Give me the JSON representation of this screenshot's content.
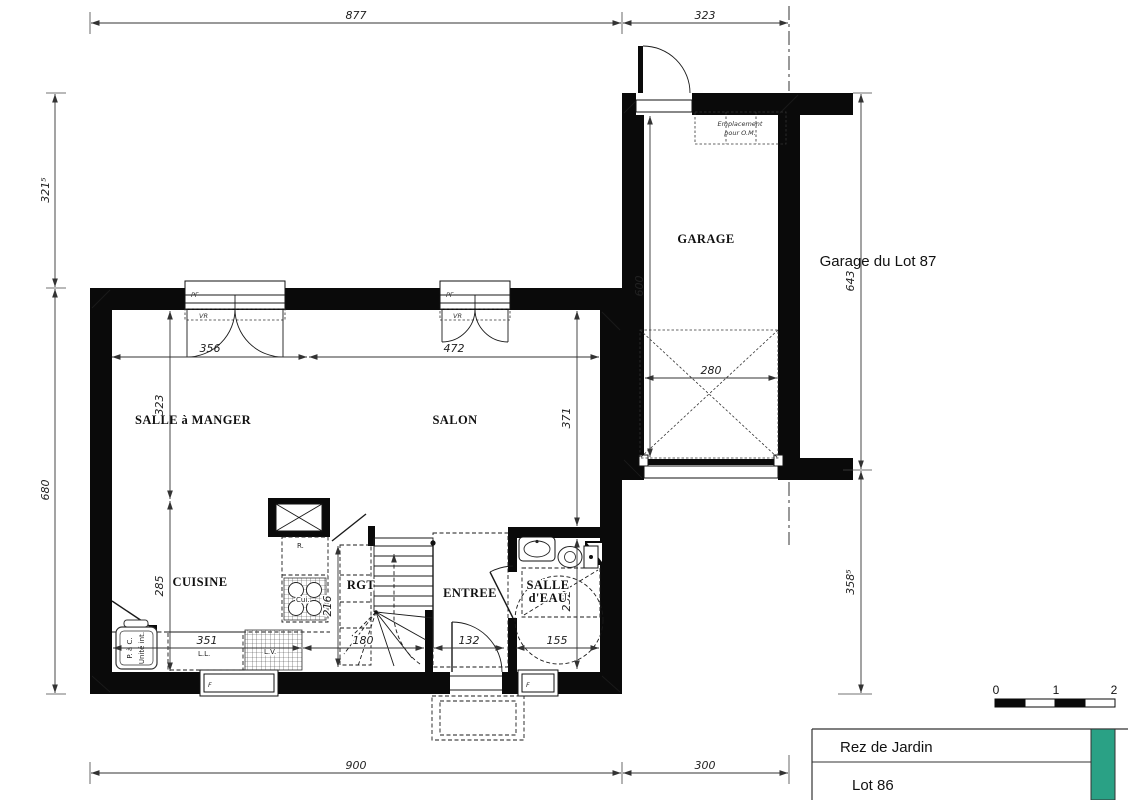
{
  "rooms": {
    "salle_a_manger": "SALLE à MANGER",
    "salon": "SALON",
    "cuisine": "CUISINE",
    "rgt": "RGT",
    "entree": "ENTREE",
    "salle_eau_1": "SALLE",
    "salle_eau_2": "d'EAU",
    "garage": "GARAGE"
  },
  "dims": {
    "d877": "877",
    "d323top": "323",
    "d3215": "321⁵",
    "d680": "680",
    "d643": "643",
    "d3585": "358⁵",
    "d900": "900",
    "d300": "300",
    "d356": "356",
    "d472": "472",
    "d323": "323",
    "d371": "371",
    "d285": "285",
    "d216": "216",
    "d232": "232",
    "d600": "600",
    "d280": "280",
    "d351": "351",
    "d180": "180",
    "d132": "132",
    "d155": "155"
  },
  "labels": {
    "garage_lot": "Garage du Lot 87",
    "om1": "Emplacement",
    "om2": "pour O.M.",
    "pac1": "P. à C.",
    "pac2": "Unité int.",
    "ll": "L.L.",
    "lv": "L.V.",
    "cui": "Cui.",
    "r": "R.",
    "pf": "PF",
    "vr": "VR",
    "f": "F"
  },
  "scalebar": {
    "t0": "0",
    "t1": "1",
    "t2": "2"
  },
  "titleblock": {
    "row1": "Rez de Jardin",
    "row2": "Lot 86"
  },
  "colors": {
    "accent": "#2aa185",
    "ink": "#111111"
  }
}
